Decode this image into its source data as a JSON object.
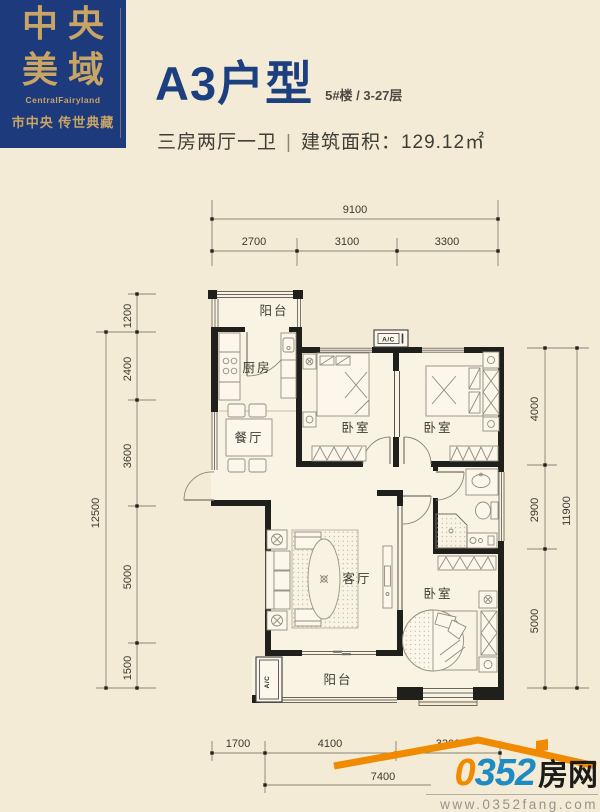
{
  "brand": {
    "line1": "中央",
    "line2": "美域",
    "name_en": "CentralFairyland",
    "tagline": "市中央 传世典藏",
    "bg_color": "#1d3a7c",
    "gold_color": "#c9a565"
  },
  "header": {
    "title": "A3户型",
    "floor_info": "5#楼 / 3-27层",
    "spec": "三房两厅一卫",
    "sep": "|",
    "area": "建筑面积：129.12㎡",
    "title_color": "#1c3f80"
  },
  "plan": {
    "labels": {
      "balcony_top": "阳台",
      "kitchen": "厨房",
      "dining": "餐厅",
      "bedroom": "卧室",
      "living": "客厅",
      "balcony_bottom": "阳台",
      "ac": "A/C"
    }
  },
  "dimensions": {
    "top": {
      "total": "9100",
      "segments": [
        "2700",
        "3100",
        "3300"
      ]
    },
    "left": {
      "total": "12500",
      "segments": [
        "1200",
        "2400",
        "3600",
        "5000",
        "1500"
      ]
    },
    "right": {
      "total": "11900",
      "segments": [
        "4000",
        "2900",
        "5000"
      ]
    },
    "bottom": {
      "total": "7400",
      "segments": [
        "1700",
        "4100",
        "3300"
      ]
    }
  },
  "footer": {
    "zero": "0",
    "num": "352",
    "cn": "房网",
    "url": "www.0352fang.com",
    "orange": "#f08a00",
    "blue": "#1e8bc3"
  }
}
